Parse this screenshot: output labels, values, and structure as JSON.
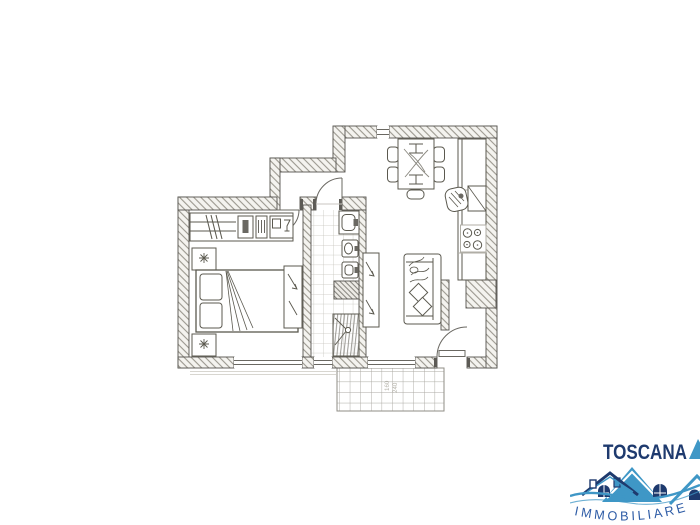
{
  "page": {
    "background_color": "#ffffff"
  },
  "floor_plan": {
    "ink_color": "#55534e",
    "wall_hatch_color": "#9b988f",
    "balcony_dimensions": [
      "160",
      "240"
    ],
    "rooms": [
      "bedroom",
      "hallway",
      "bathroom",
      "living-room-with-kitchenette",
      "balcony"
    ]
  },
  "logo": {
    "brand": "TOSCANA",
    "subtitle": "IMMOBILIARE",
    "colors": {
      "navy": "#1e3a6e",
      "light_blue": "#3f97c6",
      "subtitle_blue": "#2e5ca6"
    }
  }
}
